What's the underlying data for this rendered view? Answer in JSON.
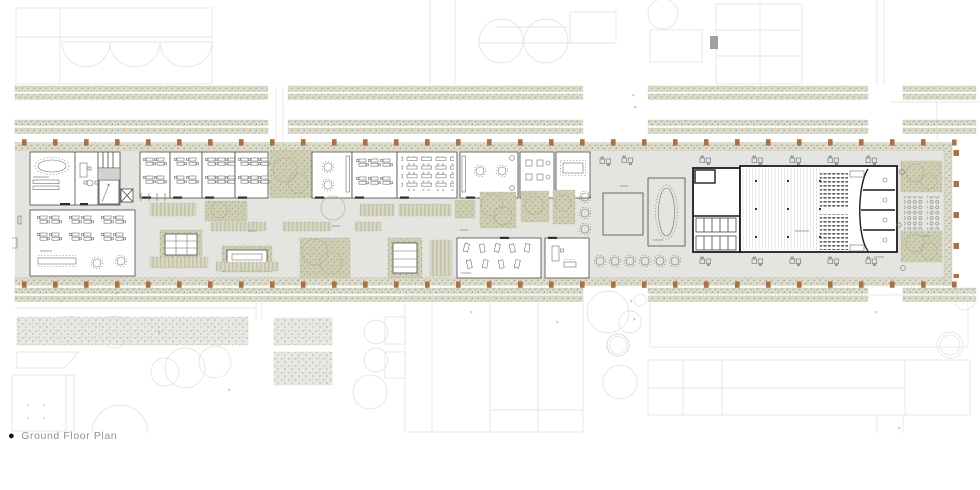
{
  "caption": {
    "bullet": "●",
    "label": "Ground Floor Plan"
  },
  "colors": {
    "context_line": "#cfcfcc",
    "floor": "#e4e4e1",
    "room_fill": "#ffffff",
    "wall": "#4a4a48",
    "wall_heavy": "#1c1c1c",
    "hedge_bg": "#dcdccb",
    "hedge_dot": "#a5a48c",
    "green_bg": "#cfcfb3",
    "green_dot": "#aeae92",
    "bed_bg": "#d8d8c2",
    "bed_line": "#b5b59a",
    "column": "#b0703e",
    "furniture": "#6f6f6d",
    "caption_text": "#919191"
  }
}
